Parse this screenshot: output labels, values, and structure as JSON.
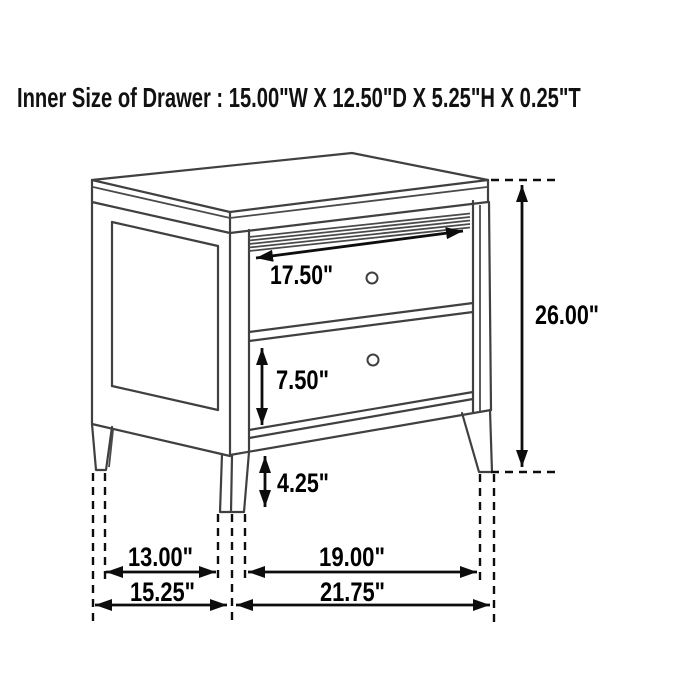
{
  "title": "Inner Size of Drawer : 15.00\"W X 12.50\"D X 5.25\"H X 0.25\"T",
  "inner_drawer_size": {
    "width": "15.00\"W",
    "depth": "12.50\"D",
    "height": "5.25\"H",
    "thickness": "0.25\"T"
  },
  "dimensions": {
    "drawer_face_width": "17.50\"",
    "lower_drawer_height": "7.50\"",
    "floor_clearance": "4.25\"",
    "overall_height": "26.00\"",
    "side_leg_span": "13.00\"",
    "front_leg_span": "19.00\"",
    "overall_depth": "15.25\"",
    "overall_width": "21.75\""
  },
  "drawing": {
    "type": "furniture-dimension-diagram",
    "item": "2-drawer nightstand line drawing",
    "knob_count": 2,
    "line_color": "#404040",
    "dimension_color": "#0d0d0d",
    "background": "#ffffff"
  }
}
